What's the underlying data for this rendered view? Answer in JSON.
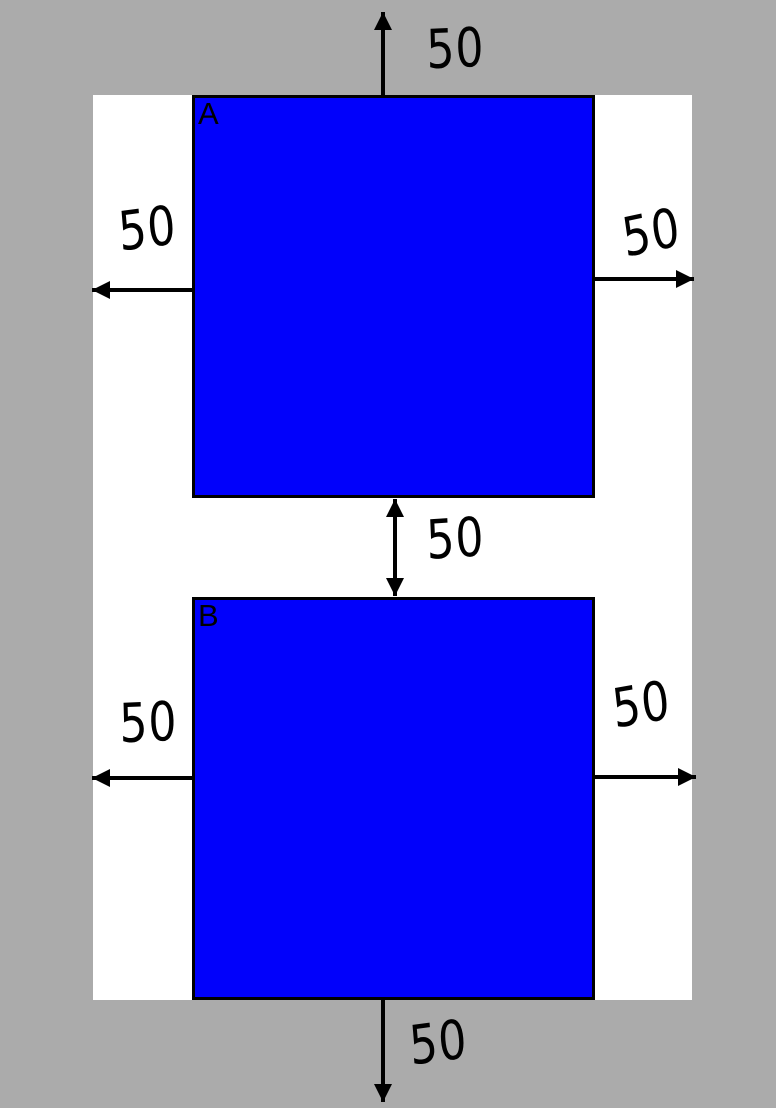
{
  "colors": {
    "background": "#ABABAB",
    "surface": "#FFFFFF",
    "square-fill": "#0101FB",
    "ink": "#000000"
  },
  "squares": {
    "a": {
      "label": "A"
    },
    "b": {
      "label": "B"
    }
  },
  "arrows": {
    "top_out": {
      "label": "50"
    },
    "a_left_out": {
      "label": "50"
    },
    "a_right_out": {
      "label": "50"
    },
    "gap_between": {
      "label": "50"
    },
    "b_left_out": {
      "label": "50"
    },
    "b_right_out": {
      "label": "50"
    },
    "bottom_out": {
      "label": "50"
    }
  }
}
